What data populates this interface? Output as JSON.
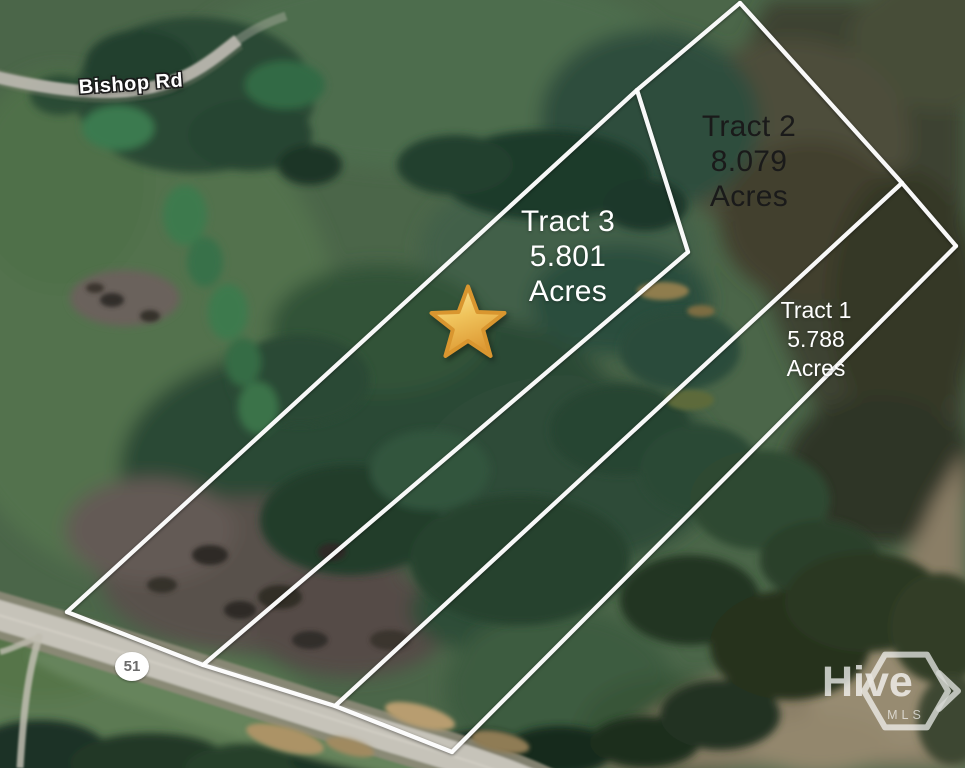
{
  "tracts": [
    {
      "name": "Tract 2",
      "acreage": "8.079",
      "unit": "Acres"
    },
    {
      "name": "Tract 3",
      "acreage": "5.801",
      "unit": "Acres"
    },
    {
      "name": "Tract 1",
      "acreage": "5.788",
      "unit": "Acres"
    }
  ],
  "roads": {
    "bishop": "Bishop Rd",
    "highway": "51"
  },
  "overlay": {
    "boundary_line_color": "#ffffff",
    "marker": "gold-star",
    "marker_color_top": "#fbe9a0",
    "marker_color_bottom": "#de9b35",
    "tract2_text_color": "#1a1a1a",
    "tract_text_color": "#ffffff",
    "badge_text_color": "#6b6b6b"
  },
  "watermark": {
    "brand": "Hive",
    "sub": "MLS"
  }
}
